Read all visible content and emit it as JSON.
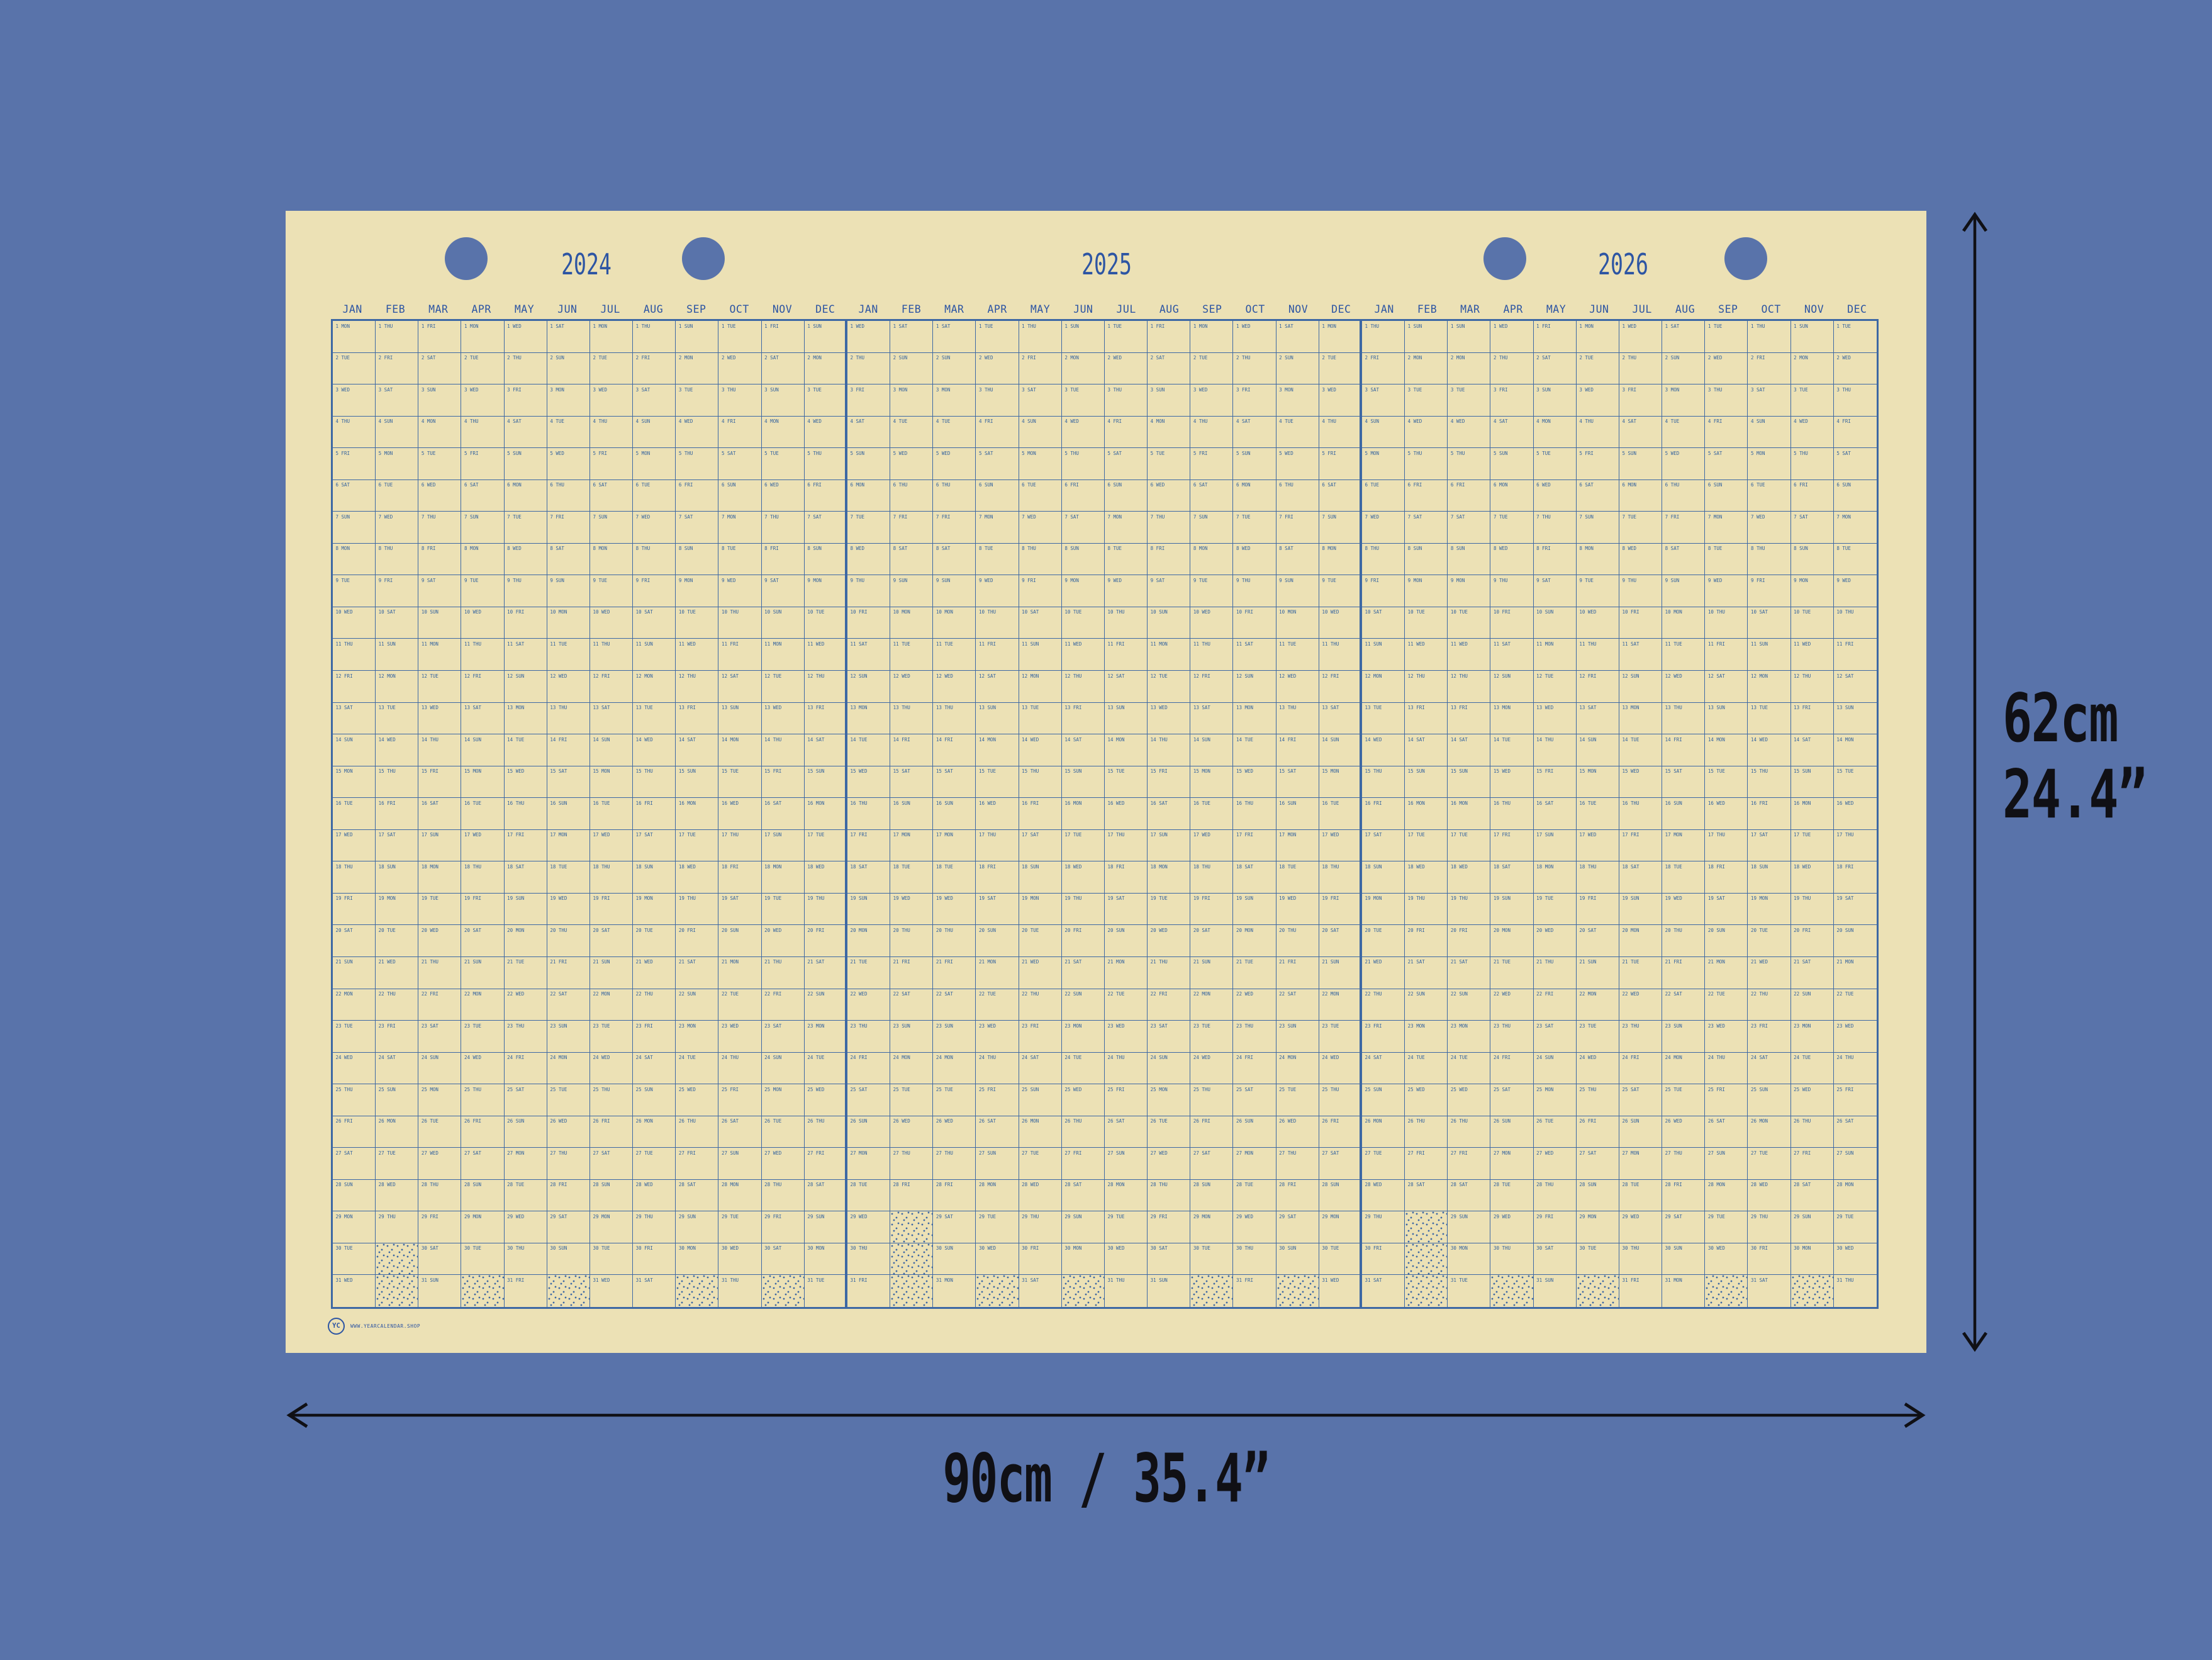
{
  "colors": {
    "background": "#5973aa",
    "poster": "#ece1b5",
    "grid_line": "#3d68a4",
    "header_text": "#2d55a3",
    "cell_text": "#33629e",
    "annotation_ink": "#101015"
  },
  "calendar": {
    "weekdays": [
      "MON",
      "TUE",
      "WED",
      "THU",
      "FRI",
      "SAT",
      "SUN"
    ],
    "years": [
      {
        "year": "2024",
        "months": [
          {
            "label": "JAN",
            "start": "MON",
            "days": 31
          },
          {
            "label": "FEB",
            "start": "THU",
            "days": 29
          },
          {
            "label": "MAR",
            "start": "FRI",
            "days": 31
          },
          {
            "label": "APR",
            "start": "MON",
            "days": 30
          },
          {
            "label": "MAY",
            "start": "WED",
            "days": 31
          },
          {
            "label": "JUN",
            "start": "SAT",
            "days": 30
          },
          {
            "label": "JUL",
            "start": "MON",
            "days": 31
          },
          {
            "label": "AUG",
            "start": "THU",
            "days": 31
          },
          {
            "label": "SEP",
            "start": "SUN",
            "days": 30
          },
          {
            "label": "OCT",
            "start": "TUE",
            "days": 31
          },
          {
            "label": "NOV",
            "start": "FRI",
            "days": 30
          },
          {
            "label": "DEC",
            "start": "SUN",
            "days": 31
          }
        ]
      },
      {
        "year": "2025",
        "months": [
          {
            "label": "JAN",
            "start": "WED",
            "days": 31
          },
          {
            "label": "FEB",
            "start": "SAT",
            "days": 28
          },
          {
            "label": "MAR",
            "start": "SAT",
            "days": 31
          },
          {
            "label": "APR",
            "start": "TUE",
            "days": 30
          },
          {
            "label": "MAY",
            "start": "THU",
            "days": 31
          },
          {
            "label": "JUN",
            "start": "SUN",
            "days": 30
          },
          {
            "label": "JUL",
            "start": "TUE",
            "days": 31
          },
          {
            "label": "AUG",
            "start": "FRI",
            "days": 31
          },
          {
            "label": "SEP",
            "start": "MON",
            "days": 30
          },
          {
            "label": "OCT",
            "start": "WED",
            "days": 31
          },
          {
            "label": "NOV",
            "start": "SAT",
            "days": 30
          },
          {
            "label": "DEC",
            "start": "MON",
            "days": 31
          }
        ]
      },
      {
        "year": "2026",
        "months": [
          {
            "label": "JAN",
            "start": "THU",
            "days": 31
          },
          {
            "label": "FEB",
            "start": "SUN",
            "days": 28
          },
          {
            "label": "MAR",
            "start": "SUN",
            "days": 31
          },
          {
            "label": "APR",
            "start": "WED",
            "days": 30
          },
          {
            "label": "MAY",
            "start": "FRI",
            "days": 31
          },
          {
            "label": "JUN",
            "start": "MON",
            "days": 30
          },
          {
            "label": "JUL",
            "start": "WED",
            "days": 31
          },
          {
            "label": "AUG",
            "start": "SAT",
            "days": 31
          },
          {
            "label": "SEP",
            "start": "TUE",
            "days": 30
          },
          {
            "label": "OCT",
            "start": "THU",
            "days": 31
          },
          {
            "label": "NOV",
            "start": "SUN",
            "days": 30
          },
          {
            "label": "DEC",
            "start": "TUE",
            "days": 31
          }
        ]
      }
    ]
  },
  "branding": {
    "logo_text": "YC",
    "website": "WWW.YEARCALENDAR.SHOP"
  },
  "dimensions": {
    "height_line1": "62cm",
    "height_line2": "24.4”",
    "width_label": "90cm / 35.4”"
  }
}
